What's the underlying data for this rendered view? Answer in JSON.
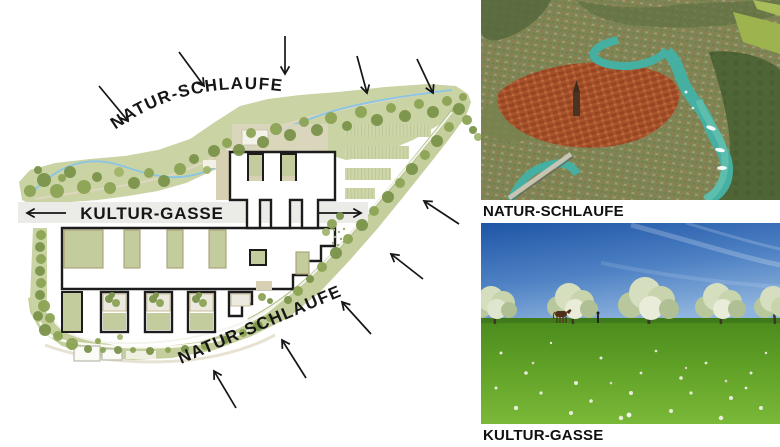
{
  "diagram": {
    "natur_schlaufe_top": "NATUR-SCHLAUFE",
    "kultur_gasse": "KULTUR-GASSE",
    "natur_schlaufe_bottom": "NATUR-SCHLAUFE"
  },
  "photos": {
    "top": {
      "caption": "NATUR-SCHLAUFE",
      "description": "Aerial view of an old town in a river loop with turquoise water"
    },
    "bottom": {
      "caption": "KULTUR-GASSE",
      "description": "Spring meadow with blossoming fruit trees, a horse and a walker under a blue sky"
    }
  },
  "colors": {
    "band_green": "#c9d3a3",
    "tree_green": "#8ca355",
    "courtyard_green": "#c3cc9c",
    "stream_blue": "#8ac4e6",
    "gasse_gray": "#ebebe8",
    "outline_black": "#1c1c1c",
    "river_teal": "#45b0a2",
    "sky_blue": "#2157a8",
    "meadow_green": "#4a8a1d"
  }
}
